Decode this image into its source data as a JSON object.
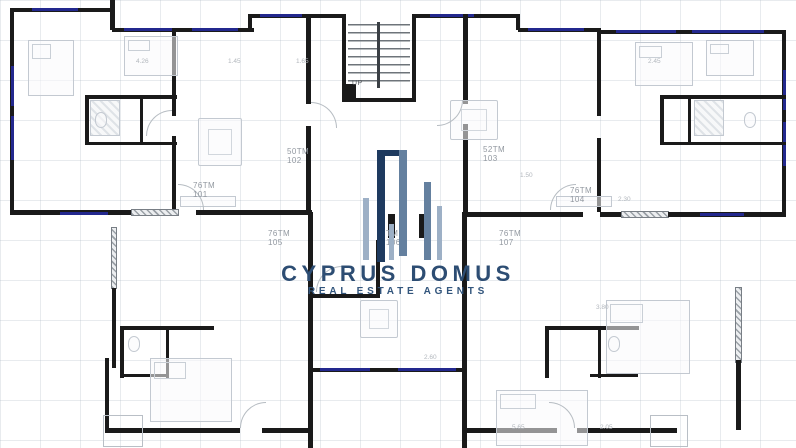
{
  "watermark": {
    "brand": "CYPRUS DOMUS",
    "tagline": "REAL ESTATE AGENTS",
    "brand_color": "#2d4d73",
    "bar_colors": {
      "dark": "#1e3a5f",
      "mid": "#64809f",
      "light": "#9db0c6"
    }
  },
  "stair": {
    "up_label": "UP"
  },
  "apartments": [
    {
      "area": "76TM",
      "number": "101"
    },
    {
      "area": "50TM",
      "number": "102"
    },
    {
      "area": "52TM",
      "number": "103"
    },
    {
      "area": "76TM",
      "number": "104"
    },
    {
      "area": "76TM",
      "number": "105"
    },
    {
      "area": "TM",
      "number": "106"
    },
    {
      "area": "76TM",
      "number": "107"
    }
  ],
  "dimensions": [
    "4.26",
    "1.45",
    "1.65",
    "2.45",
    "1.50",
    "2.30",
    "3.80",
    "2.60",
    "5.65",
    "2.05"
  ],
  "colors": {
    "wall": "#1a1a1a",
    "window": "#23288e",
    "grid": "#c9d2da",
    "label": "#9298a0"
  }
}
